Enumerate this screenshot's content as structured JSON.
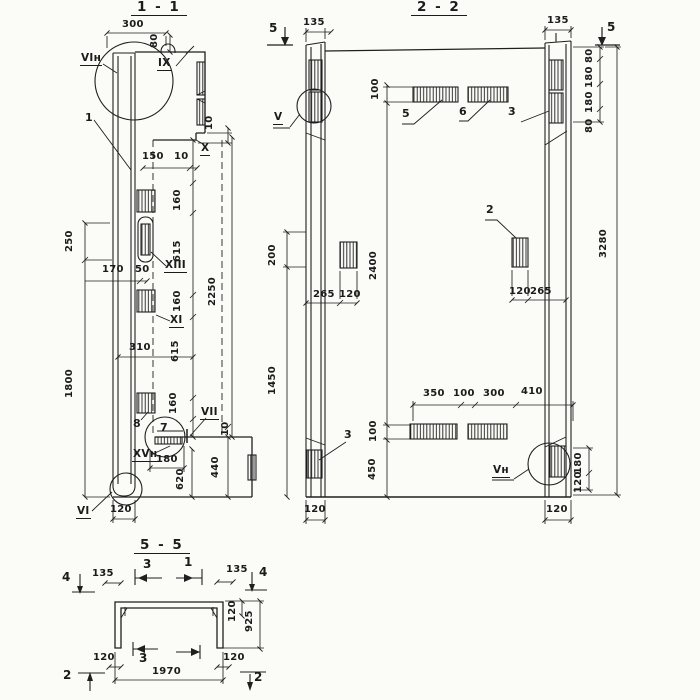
{
  "sheet": {
    "ink": "#1f1f1f",
    "paper": "#fbfbf8"
  },
  "s11": {
    "title": "1 - 1",
    "c_vin": "VIн",
    "c_1": "1",
    "c_ix": "IX",
    "c_x": "X",
    "c_xiii": "XIII",
    "c_xi": "XI",
    "c_8": "8",
    "c_7": "7",
    "c_vii": "VII",
    "c_xvn": "XVн",
    "c_vi": "VI",
    "d_300": "300",
    "d_80": "80",
    "d_150": "150",
    "d_10a": "10",
    "d_10b": "10",
    "d_10c": "10",
    "d_160a": "160",
    "d_615a": "615",
    "d_160b": "160",
    "d_615b": "615",
    "d_160c": "160",
    "d_2250": "2250",
    "d_250": "250",
    "d_170": "170",
    "d_50": "50",
    "d_1800": "1800",
    "d_310": "310",
    "d_440": "440",
    "d_180": "180",
    "d_620": "620",
    "d_120": "120"
  },
  "s22": {
    "title": "2 - 2",
    "m_5l": "5",
    "m_5r": "5",
    "c_v": "V",
    "c_5": "5",
    "c_6": "6",
    "c_2": "2",
    "c_3l": "3",
    "c_3r": "3",
    "c_vn": "Vн",
    "d_135l": "135",
    "d_135r": "135",
    "d_100t": "100",
    "d_80a": "80",
    "d_180a": "180",
    "d_180b": "180",
    "d_80b": "80",
    "d_3280": "3280",
    "d_200": "200",
    "d_2400": "2400",
    "d_265l": "265",
    "d_120l": "120",
    "d_120r": "120",
    "d_265r": "265",
    "d_1450": "1450",
    "d_350": "350",
    "d_100m": "100",
    "d_300": "300",
    "d_410": "410",
    "d_100b": "100",
    "d_450": "450",
    "d_180side": "180",
    "d_120side": "120",
    "d_120bl": "120",
    "d_120br": "120"
  },
  "s55": {
    "title": "5 - 5",
    "m_4l": "4",
    "m_3t": "3",
    "m_1t": "1",
    "m_4r": "4",
    "m_3b": "3",
    "m_2l": "2",
    "m_2r": "2",
    "d_135l": "135",
    "d_135r": "135",
    "d_120t": "120",
    "d_925": "925",
    "d_120bl": "120",
    "d_1970": "1970",
    "d_120br": "120"
  }
}
